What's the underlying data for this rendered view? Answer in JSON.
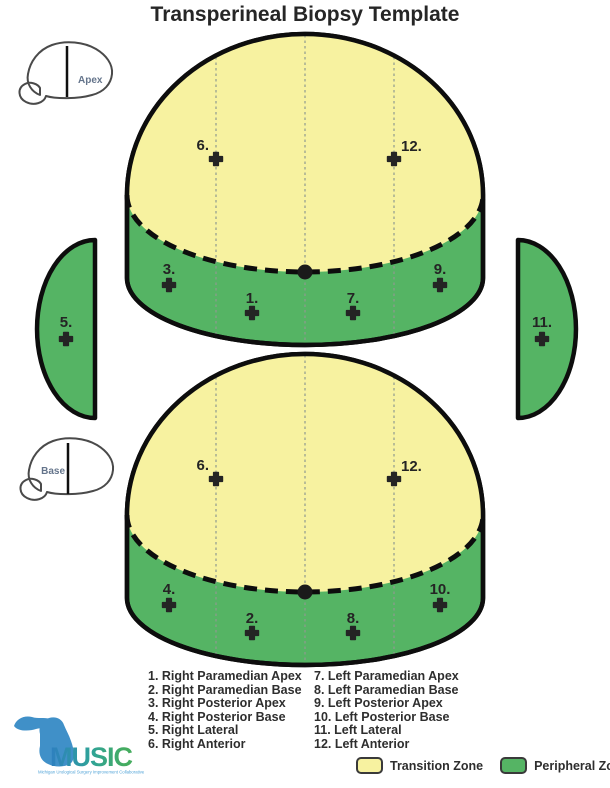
{
  "title": "Transperineal Biopsy Template",
  "views": {
    "apex": {
      "label": "Apex",
      "markers": {
        "m6": "6.",
        "m12": "12.",
        "m3": "3.",
        "m1": "1.",
        "m7": "7.",
        "m9": "9.",
        "m5": "5."
      }
    },
    "base": {
      "label": "Base",
      "markers": {
        "m6": "6.",
        "m12": "12.",
        "m4": "4.",
        "m2": "2.",
        "m8": "8.",
        "m10": "10.",
        "m11": "11."
      }
    }
  },
  "key": {
    "left": [
      "1. Right Paramedian Apex",
      "2. Right Paramedian Base",
      "3. Right Posterior Apex",
      "4. Right Posterior Base",
      "5. Right Lateral",
      "6. Right Anterior"
    ],
    "right": [
      "7. Left Paramedian Apex",
      "8. Left Paramedian Base",
      "9. Left Posterior Apex",
      "10. Left Posterior Base",
      "11. Left Lateral",
      "12. Left Anterior"
    ]
  },
  "zone_legend": {
    "transition": {
      "label": "Transition Zone",
      "color": "#F7F2A0"
    },
    "peripheral": {
      "label": "Peripheral Zone",
      "color": "#55B464"
    }
  },
  "logo": {
    "name": "MUSIC",
    "tagline": "Michigan Urological Surgery Improvement Collaborative"
  },
  "colors": {
    "transition_zone": "#F7F2A0",
    "peripheral_zone": "#55B464",
    "outline": "#0d0d0d",
    "logo_blue": "#4090C8",
    "logo_green": "#45AC5F"
  }
}
